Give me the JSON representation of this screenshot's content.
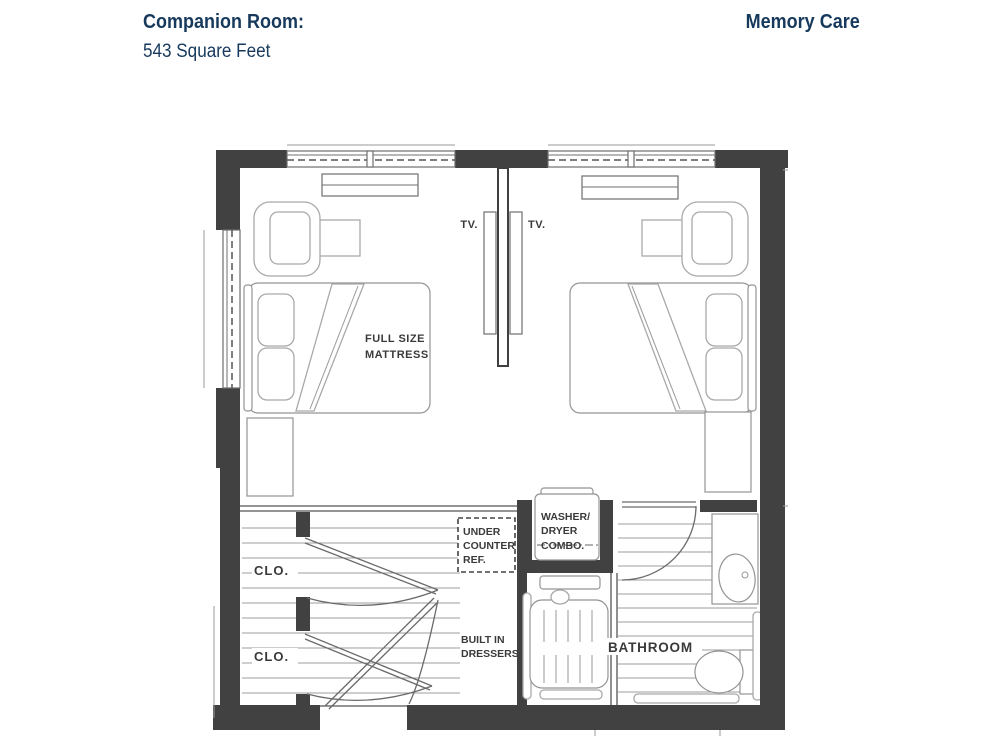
{
  "header": {
    "room_title": "Companion Room:",
    "room_area": "543 Square Feet",
    "program": "Memory Care"
  },
  "colors": {
    "heading_navy": "#17395c",
    "wall_dark": "#414141",
    "line_gray": "#9c9c9c",
    "label_gray": "#3a3a3a",
    "background": "#ffffff"
  },
  "floorplan": {
    "labels": {
      "tv_left": "TV.",
      "tv_right": "TV.",
      "mattress_line1": "FULL SIZE",
      "mattress_line2": "MATTRESS",
      "closet_upper": "CLO.",
      "closet_lower": "CLO.",
      "ref_line1": "UNDER",
      "ref_line2": "COUNTER",
      "ref_line3": "REF.",
      "washer_line1": "WASHER/",
      "washer_line2": "DRYER",
      "washer_line3": "COMBO.",
      "dressers_line1": "BUILT IN",
      "dressers_line2": "DRESSERS",
      "bathroom": "BATHROOM"
    }
  }
}
